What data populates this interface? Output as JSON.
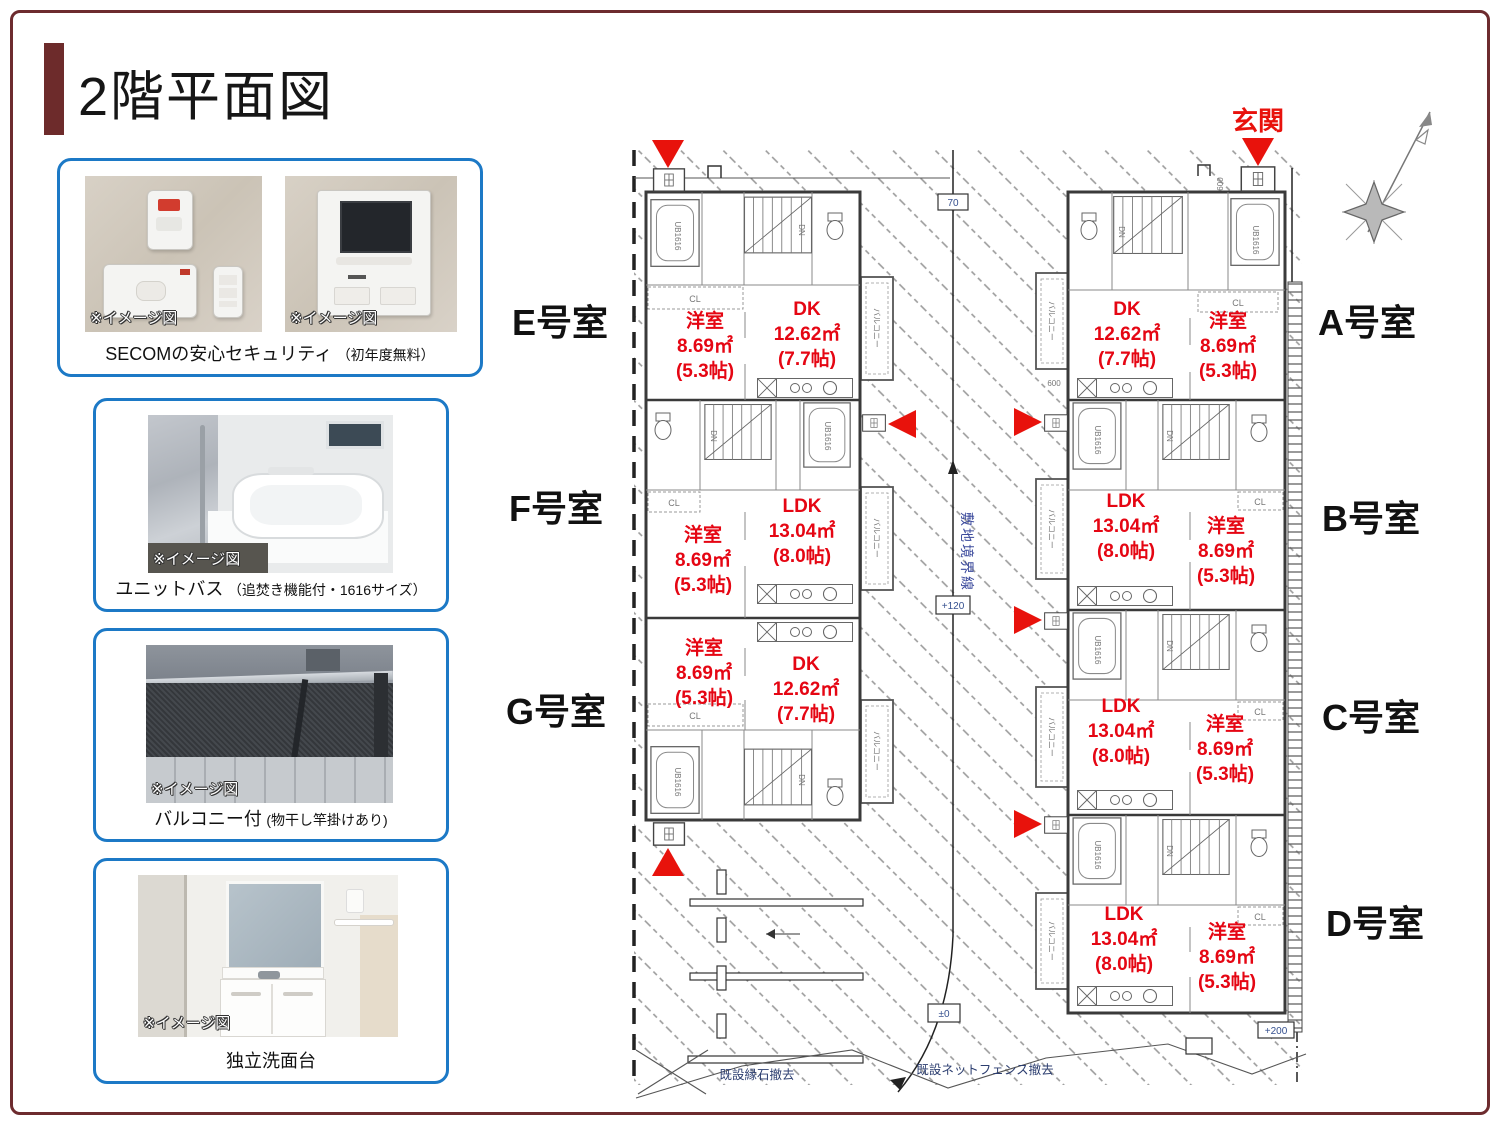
{
  "page": {
    "title": "2階平面図"
  },
  "colors": {
    "frame": "#6d2b2e",
    "card_border": "#1c79c6",
    "room_red": "#e50613",
    "arrow_red": "#e8120c"
  },
  "cards": [
    {
      "note": "※イメージ図",
      "caption": "SECOMの安心セキュリティ",
      "caption_sub": "（初年度無料）"
    },
    {
      "note": "※イメージ図",
      "caption": "ユニットバス",
      "caption_sub": "（追焚き機能付・1616サイズ）"
    },
    {
      "note": "※イメージ図",
      "caption": "バルコニー付",
      "caption_sub": "(物干し竿掛けあり)"
    },
    {
      "note": "※イメージ図",
      "caption": "独立洗面台",
      "caption_sub": ""
    }
  ],
  "plan": {
    "entrance": "玄関",
    "units": {
      "E": {
        "label": "E号室",
        "room1": {
          "name": "洋室",
          "area": "8.69㎡",
          "size": "(5.3帖)"
        },
        "room2": {
          "name": "DK",
          "area": "12.62㎡",
          "size": "(7.7帖)"
        }
      },
      "F": {
        "label": "F号室",
        "room1": {
          "name": "洋室",
          "area": "8.69㎡",
          "size": "(5.3帖)"
        },
        "room2": {
          "name": "LDK",
          "area": "13.04㎡",
          "size": "(8.0帖)"
        }
      },
      "G": {
        "label": "G号室",
        "room1": {
          "name": "洋室",
          "area": "8.69㎡",
          "size": "(5.3帖)"
        },
        "room2": {
          "name": "DK",
          "area": "12.62㎡",
          "size": "(7.7帖)"
        }
      },
      "A": {
        "label": "A号室",
        "room1": {
          "name": "DK",
          "area": "12.62㎡",
          "size": "(7.7帖)"
        },
        "room2": {
          "name": "洋室",
          "area": "8.69㎡",
          "size": "(5.3帖)"
        }
      },
      "B": {
        "label": "B号室",
        "room1": {
          "name": "LDK",
          "area": "13.04㎡",
          "size": "(8.0帖)"
        },
        "room2": {
          "name": "洋室",
          "area": "8.69㎡",
          "size": "(5.3帖)"
        }
      },
      "C": {
        "label": "C号室",
        "room1": {
          "name": "LDK",
          "area": "13.04㎡",
          "size": "(8.0帖)"
        },
        "room2": {
          "name": "洋室",
          "area": "8.69㎡",
          "size": "(5.3帖)"
        }
      },
      "D": {
        "label": "D号室",
        "room1": {
          "name": "LDK",
          "area": "13.04㎡",
          "size": "(8.0帖)"
        },
        "room2": {
          "name": "洋室",
          "area": "8.69㎡",
          "size": "(5.3帖)"
        }
      }
    },
    "labels": {
      "boundary": "敷地境界線",
      "fence": "既設ネットフェンス撤去",
      "curb": "既設縁石撤去",
      "balcony": "バルコニー",
      "ub": "UB1616",
      "dn": "DN",
      "cl": "CL",
      "dim600": "600",
      "plus200": "+200",
      "plus120": "+120",
      "pm0": "±0",
      "dim70": "70"
    }
  }
}
